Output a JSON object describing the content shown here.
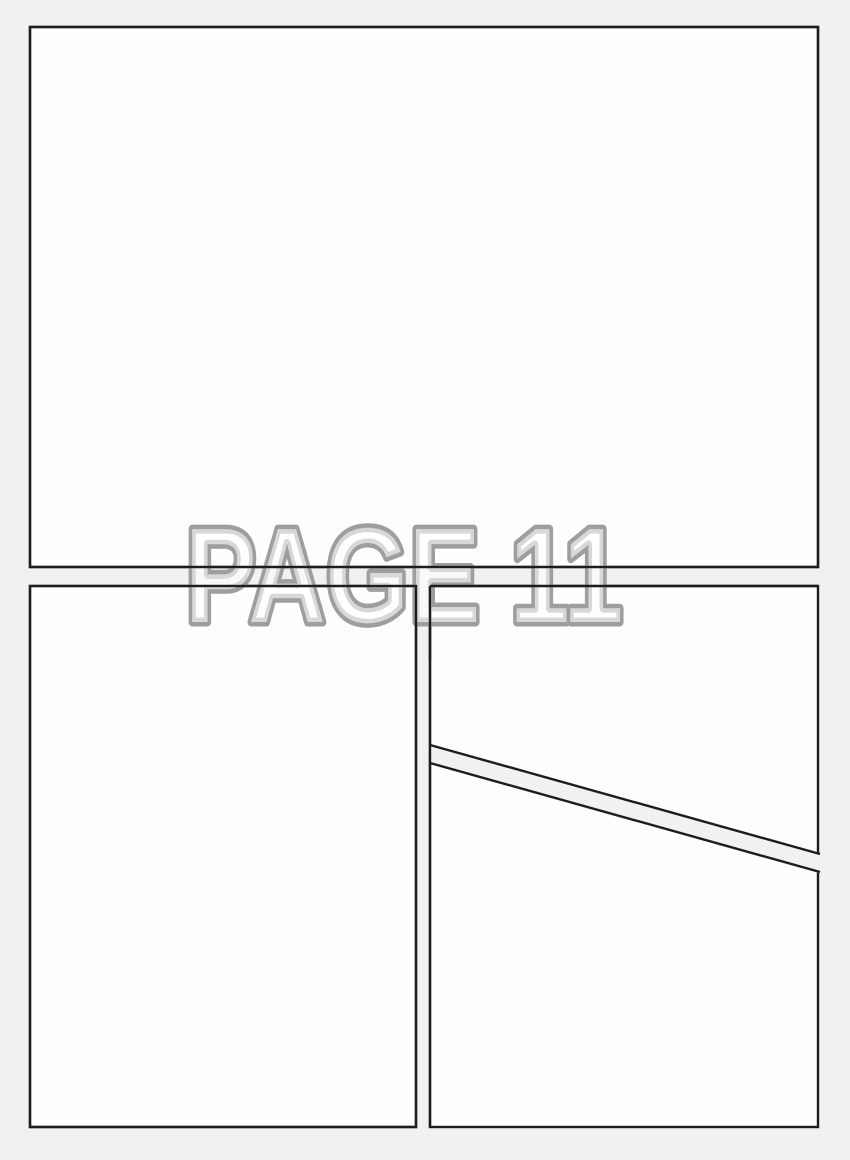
{
  "page_label": "PAGE 11",
  "panels": [
    {
      "name": "top",
      "shape": "rectangle"
    },
    {
      "name": "bottom-left",
      "shape": "rectangle"
    },
    {
      "name": "bottom-right-upper",
      "shape": "polygon"
    },
    {
      "name": "bottom-right-lower",
      "shape": "polygon"
    }
  ],
  "colors": {
    "background": "#f1f1f2",
    "panel_fill": "#fefefe",
    "panel_border": "#1d1d1f",
    "label_stroke": "#9e9e9e",
    "label_fill": "rgba(255,255,255,0.6)"
  }
}
